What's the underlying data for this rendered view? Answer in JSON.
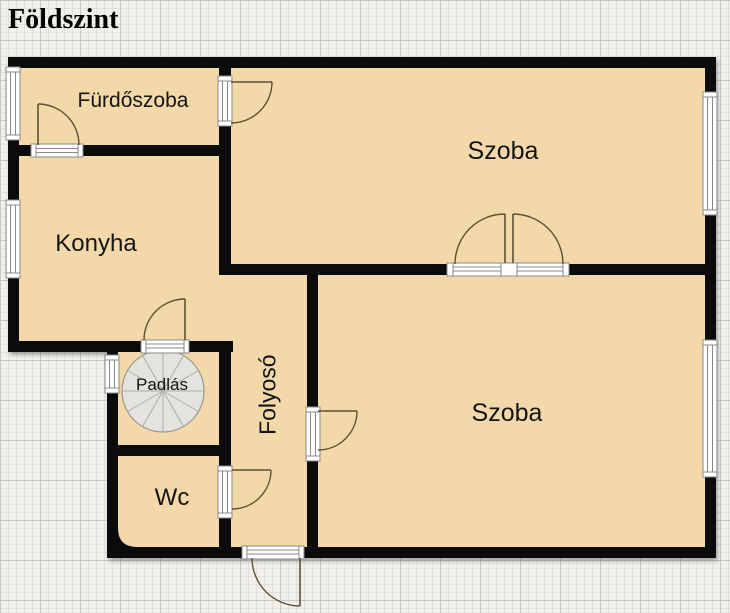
{
  "title": "Földszint",
  "rooms": [
    {
      "label": "Fürdőszoba"
    },
    {
      "label": "Konyha"
    },
    {
      "label": "Szoba"
    },
    {
      "label": "Padlás"
    },
    {
      "label": "Folyosó"
    },
    {
      "label": "Wc"
    },
    {
      "label": "Szoba"
    }
  ],
  "features": {
    "window_count": 5,
    "door_count": 7,
    "double_door_count": 1,
    "entrance_door": "bottom, opens outward",
    "staircase": "spiral"
  },
  "colors": {
    "floor": "#f3d9a9",
    "wall": "#0b0b0b",
    "grid_bg": "#f1f0eb",
    "grid_minor": "#e2e0d8",
    "grid_major": "#c9c7c1",
    "door_arc": "#5e5034",
    "frame_stroke": "#8a8a8a",
    "stair": "#e4e3df",
    "stair_stroke": "#97968f",
    "text": "#141414"
  }
}
